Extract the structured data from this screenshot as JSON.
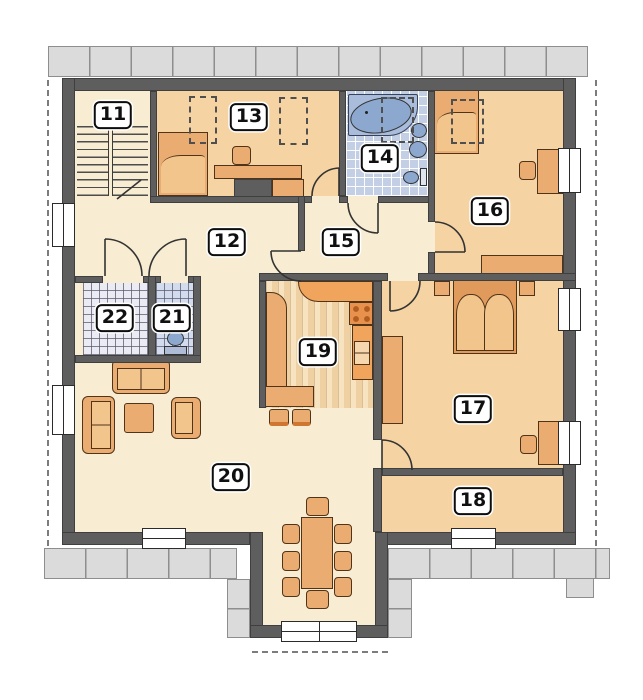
{
  "plan": {
    "figure": "upper-floor architectural plan",
    "rooms": [
      {
        "label": "11"
      },
      {
        "label": "12"
      },
      {
        "label": "13"
      },
      {
        "label": "14"
      },
      {
        "label": "15"
      },
      {
        "label": "16"
      },
      {
        "label": "17"
      },
      {
        "label": "18"
      },
      {
        "label": "19"
      },
      {
        "label": "20"
      },
      {
        "label": "21"
      },
      {
        "label": "22"
      }
    ],
    "colors": {
      "wall": "#5e5e5e",
      "floor_cream": "#f8ecd2",
      "floor_orange": "#f5d3a3",
      "kitchen_wood_a": "#f7e3bf",
      "kitchen_wood_b": "#efd0a2",
      "furniture": "#eaac70",
      "furniture_light": "#f2c58d",
      "counter_orange": "#f0a45c",
      "bath_tile": "#c3cfe4",
      "storage_tile": "#ebebf3",
      "wc_tile": "#d3dcee",
      "fixture_blue": "#8da8cf",
      "paving": "#dbdbdc",
      "badge_bg": "#ffffff",
      "badge_border": "#0d0d0d"
    }
  }
}
